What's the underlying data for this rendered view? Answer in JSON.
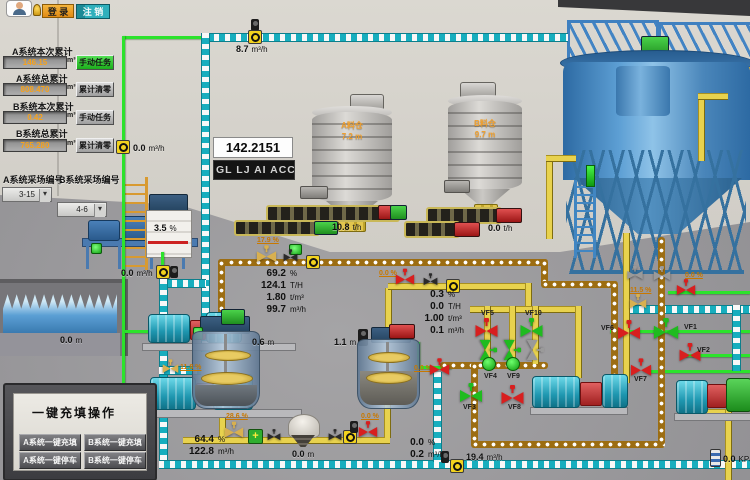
{
  "chrome": {
    "login": "登 录",
    "logout": "注 销"
  },
  "acc": {
    "r1_label": "A系统本次累计",
    "r1_value": "146.15",
    "r1_unit": "m³",
    "r1_btn": "手动任务",
    "r2_label": "A系统总累计",
    "r2_value": "808.470",
    "r2_unit": "m³",
    "r2_btn": "累计清零",
    "r3_label": "B系统本次累计",
    "r3_value": "0.42",
    "r3_unit": "m³",
    "r3_btn": "手动任务",
    "r4_label": "B系统总累计",
    "r4_value": "765.280",
    "r4_unit": "m³",
    "r4_btn": "累计清零"
  },
  "stope": {
    "a_label": "A系统采场编号",
    "a_value": "3-15",
    "b_label": "B系统采场编号",
    "b_value": "4-6"
  },
  "onekey": {
    "title": "一键充填操作",
    "a_fill": "A系统一键充填",
    "b_fill": "B系统一键充填",
    "a_stop": "A系统一键停车",
    "b_stop": "B系统一键停车"
  },
  "display": {
    "accumulator": "142.2151",
    "marquee": "GL LJ AI ACC"
  },
  "silos": {
    "a_name": "A料仓",
    "a_level": "7.2",
    "a_unit": "m",
    "b_name": "B料仓",
    "b_level": "9.7",
    "b_unit": "m"
  },
  "flows": {
    "top": {
      "v": "8.7",
      "u": "m³/h"
    },
    "wall": {
      "v": "0.0",
      "u": "m³/h"
    },
    "station": {
      "v": "0.0",
      "u": "m³/h"
    },
    "conv_a": {
      "v": "10.8",
      "u": "t/h"
    },
    "conv_b": {
      "v": "0.0",
      "u": "t/h"
    },
    "bottom": {
      "v": "19.4",
      "u": "m³/h"
    },
    "pressure": {
      "v": "0.0",
      "u": "KPa"
    }
  },
  "levels": {
    "tank": {
      "v": "3.5",
      "u": "%"
    },
    "pool": {
      "v": "0.0",
      "u": "m"
    },
    "mix1": {
      "v": "0.6",
      "u": "m"
    },
    "mix2": {
      "v": "1.1",
      "u": "m"
    },
    "hopper": {
      "v": "0.0",
      "u": "m"
    }
  },
  "block1": {
    "r1v": "69.2",
    "r1u": "%",
    "r2v": "124.1",
    "r2u": "T/H",
    "r3v": "1.80",
    "r3u": "t/m³",
    "r4v": "99.7",
    "r4u": "m³/h"
  },
  "block2": {
    "r1v": "0.3",
    "r1u": "%",
    "r2v": "0.0",
    "r2u": "T/H",
    "r3v": "1.00",
    "r3u": "t/m³",
    "r4v": "0.1",
    "r4u": "m³/h"
  },
  "block3": {
    "r1v": "64.4",
    "r1u": "%",
    "r2v": "122.8",
    "r2u": "m³/h"
  },
  "block4": {
    "r1v": "0.0",
    "r1u": "%",
    "r2v": "0.2",
    "r2u": "m³/h"
  },
  "pcts": {
    "feed": "17.9 %",
    "flush": "11.8 %",
    "discharge": "28.6 %",
    "thickener": "11.5 %",
    "z1": "0.0 %",
    "z2": "0.0 %",
    "z3": "0.0 %",
    "z4": "0.0 %"
  },
  "valves": {
    "vf1": "VF1",
    "vf2": "VF2",
    "vf3": "VF3",
    "vf4": "VF4",
    "vf5": "VF5",
    "vf6": "VF6",
    "vf7": "VF7",
    "vf8": "VF8",
    "vf9": "VF9",
    "vf10": "VF10"
  },
  "colors": {
    "pipe_green": "#2ce32c",
    "pipe_cyan": "#17aebe",
    "pipe_slurry": "#9c6d12",
    "pipe_yellow": "#e8d24e",
    "valve_open": "#1fbb1f",
    "valve_closed": "#d81f1f",
    "value_orange": "#f6a21c",
    "login_orange": "#e99a20",
    "logout_teal": "#2fb0bc"
  }
}
